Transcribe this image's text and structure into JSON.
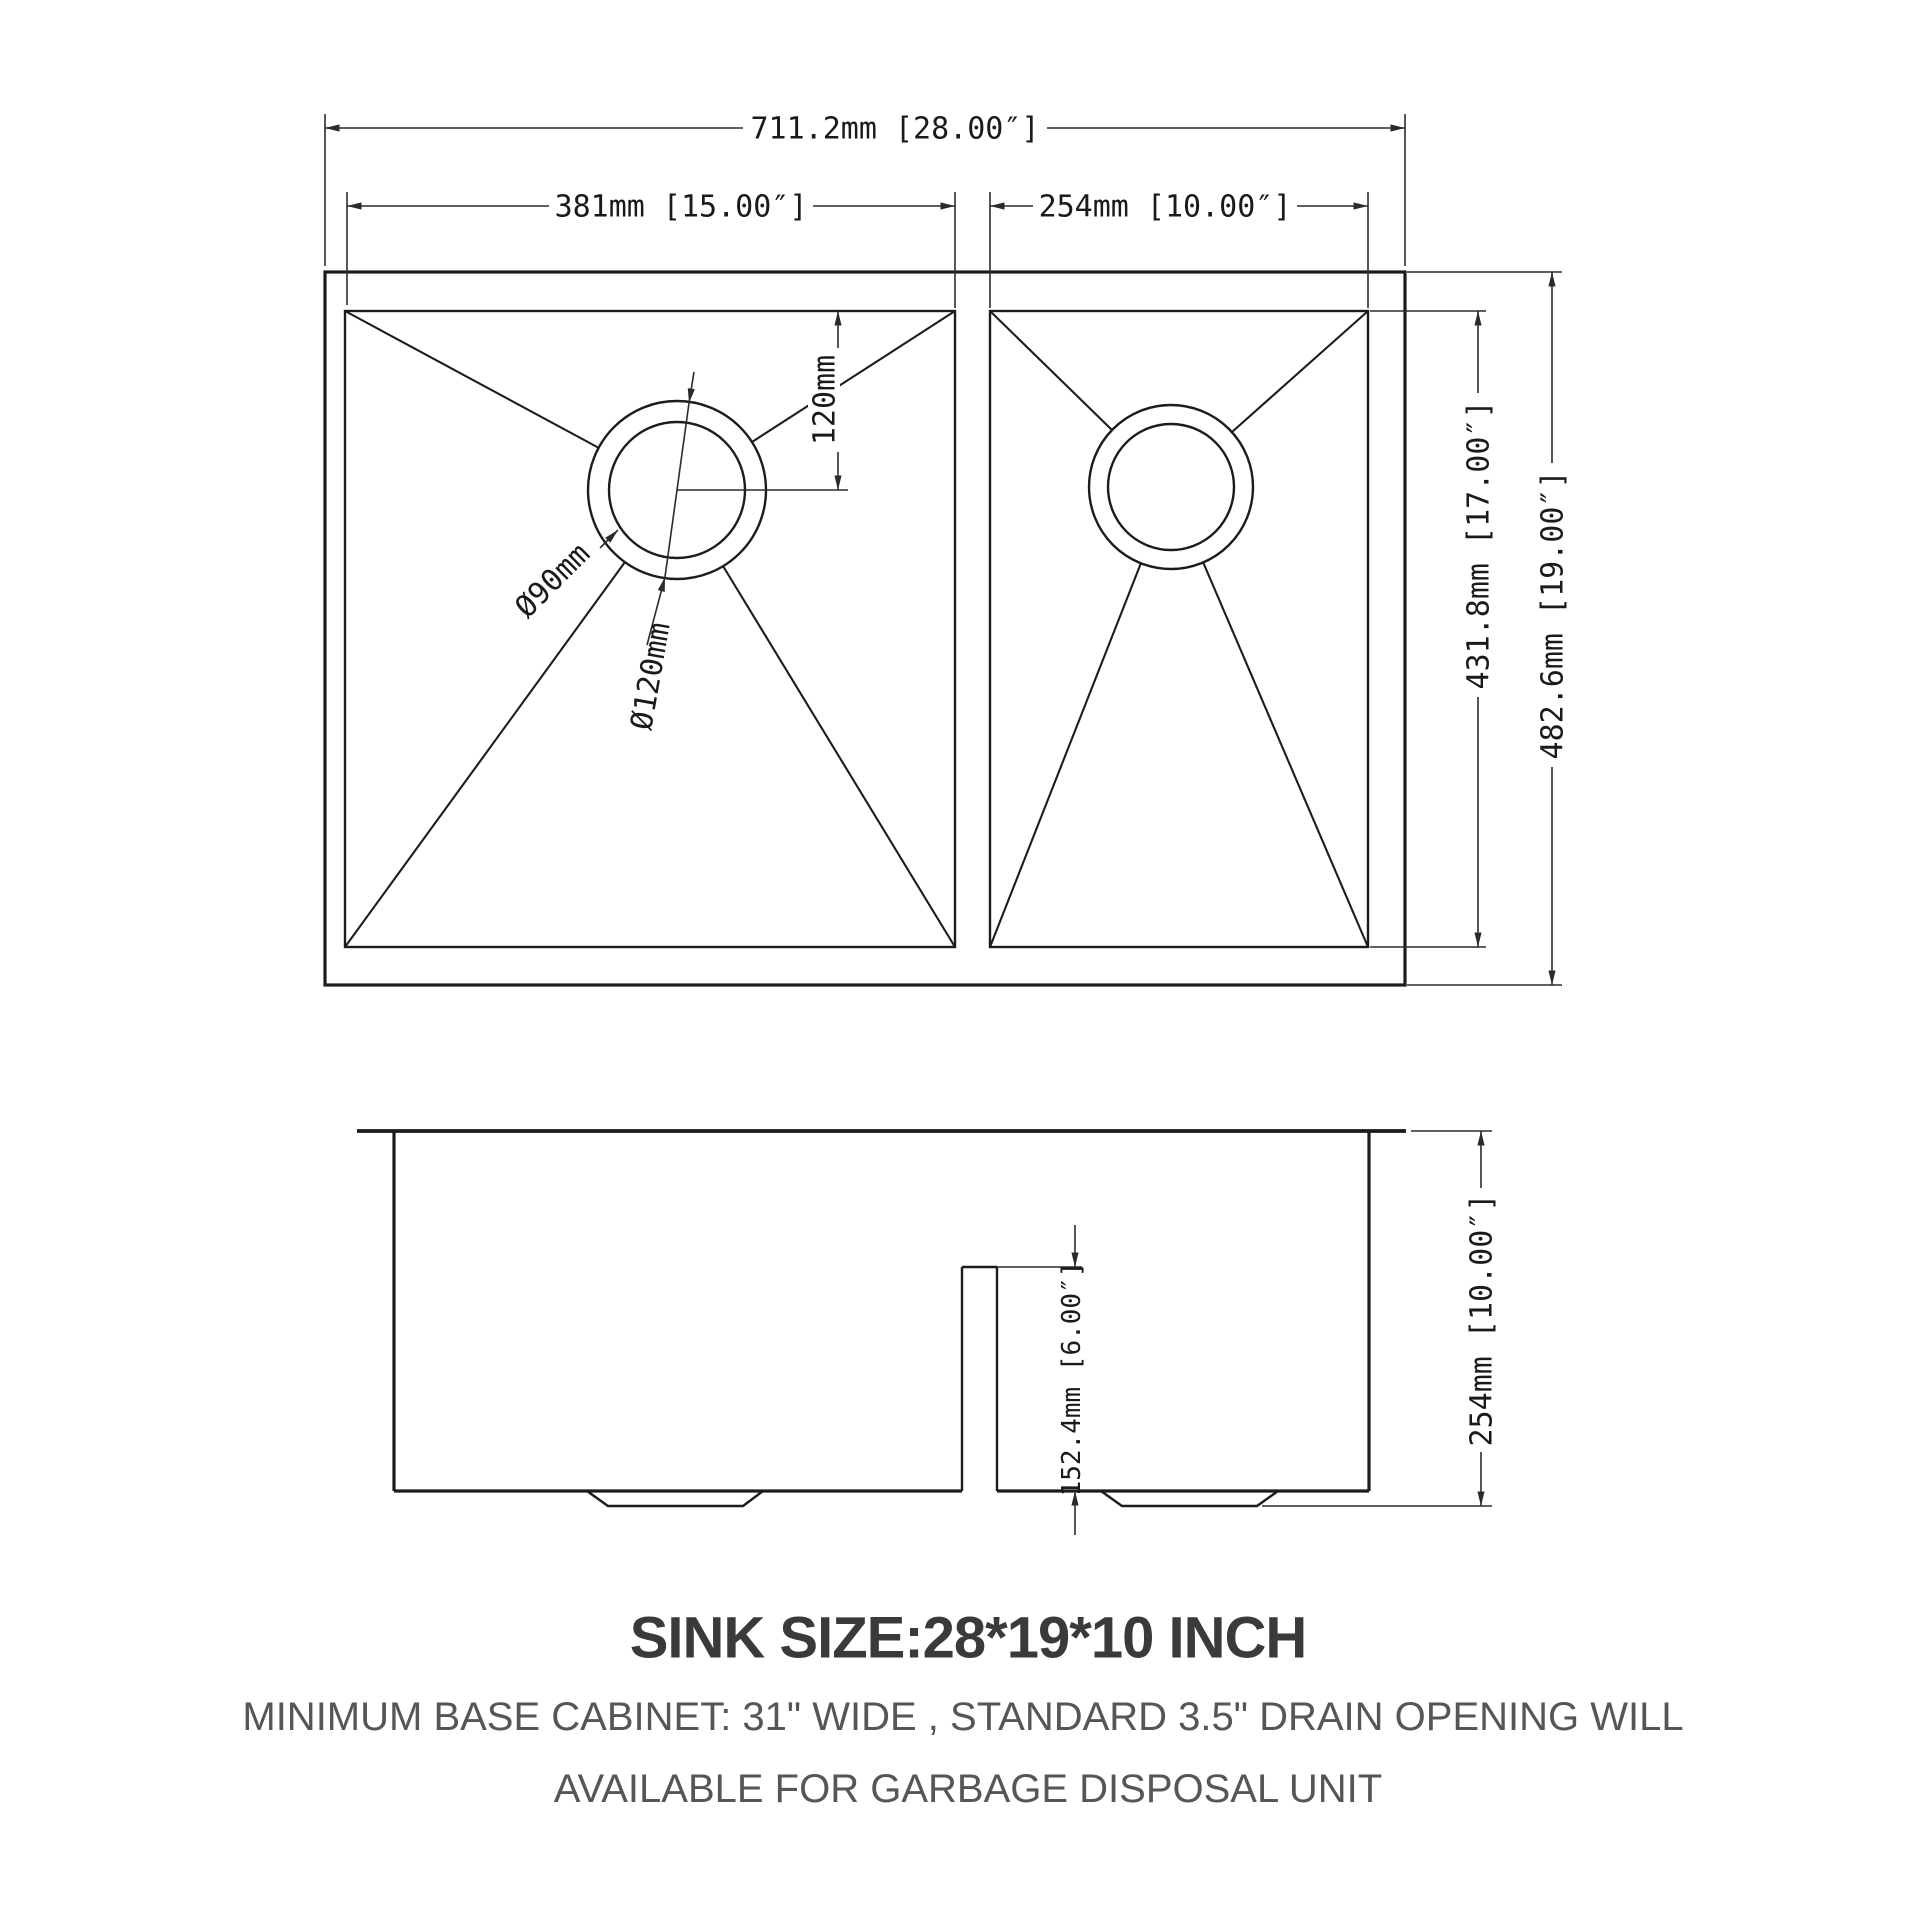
{
  "colors": {
    "bg": "#ffffff",
    "line": "#1c1c1c",
    "dim": "#2b2b2b",
    "title": "#3a3a3a",
    "note": "#565656"
  },
  "top_view": {
    "dims": {
      "overall_width": "711.2mm [28.00″]",
      "left_bowl_width": "381mm [15.00″]",
      "right_bowl_width": "254mm [10.00″]",
      "drain_offset_from_top": "120mm",
      "drain_inner_diameter": "Ø90mm",
      "drain_outer_diameter": "Ø120mm",
      "bowl_depth": "431.8mm [17.00″]",
      "overall_depth": "482.6mm [19.00″]"
    }
  },
  "side_view": {
    "dims": {
      "divider_reveal_height": "152.4mm [6.00″]",
      "overall_height": "254mm [10.00″]"
    }
  },
  "caption": {
    "title": "SINK SIZE:28*19*10 INCH",
    "note_line1": "MINIMUM BASE CABINET: 31\" WIDE , STANDARD 3.5\" DRAIN OPENING WILL",
    "note_line2": "AVAILABLE FOR GARBAGE DISPOSAL UNIT"
  }
}
